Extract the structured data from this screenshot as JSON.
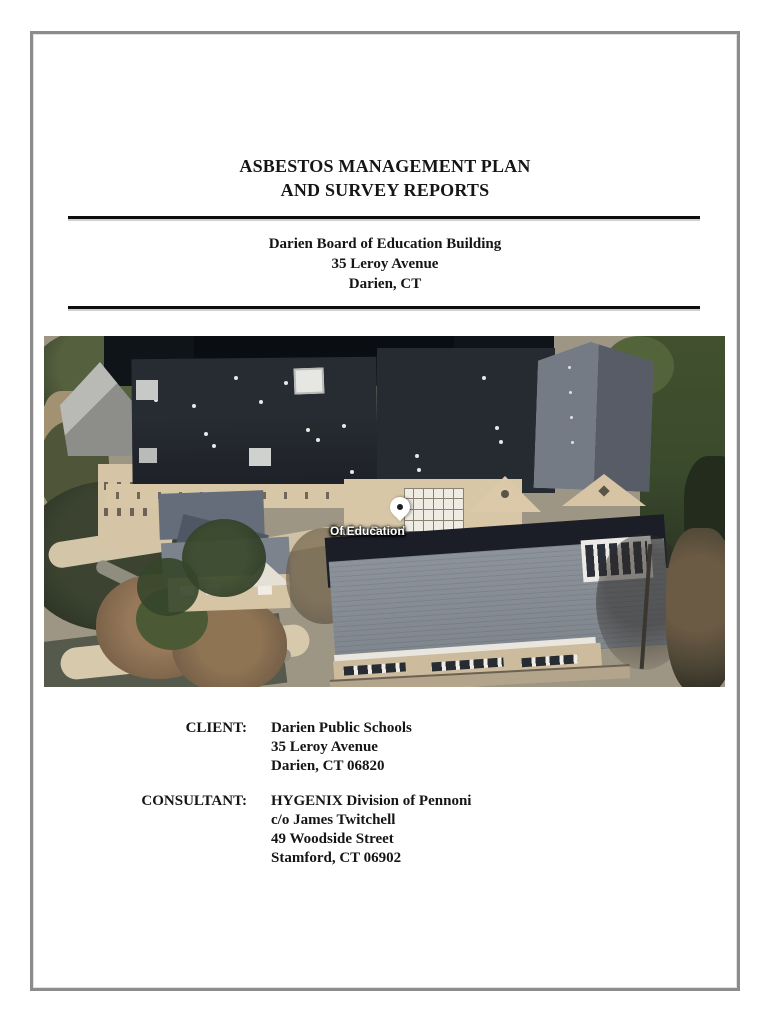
{
  "document": {
    "title_line1": "ASBESTOS MANAGEMENT PLAN",
    "title_line2": "AND SURVEY REPORTS",
    "building_name": "Darien Board of Education Building",
    "building_address": "35 Leroy Avenue",
    "building_city": "Darien, CT"
  },
  "photo": {
    "map_pin_label_line1": "Darien Board",
    "map_pin_label_line2": "Of Education"
  },
  "parties": {
    "client_label": "CLIENT:",
    "client_lines": [
      "Darien Public Schools",
      "35 Leroy Avenue",
      "Darien, CT 06820"
    ],
    "consultant_label": "CONSULTANT:",
    "consultant_lines": [
      "HYGENIX Division of Pennoni",
      "c/o James Twitchell",
      "49 Woodside Street",
      "Stamford, CT 06902"
    ]
  },
  "colors": {
    "page_border": "#8c8c8c",
    "rule": "#0d0d0d",
    "roof_dark": "#23262c",
    "wall_tan": "#d8c7a7"
  }
}
